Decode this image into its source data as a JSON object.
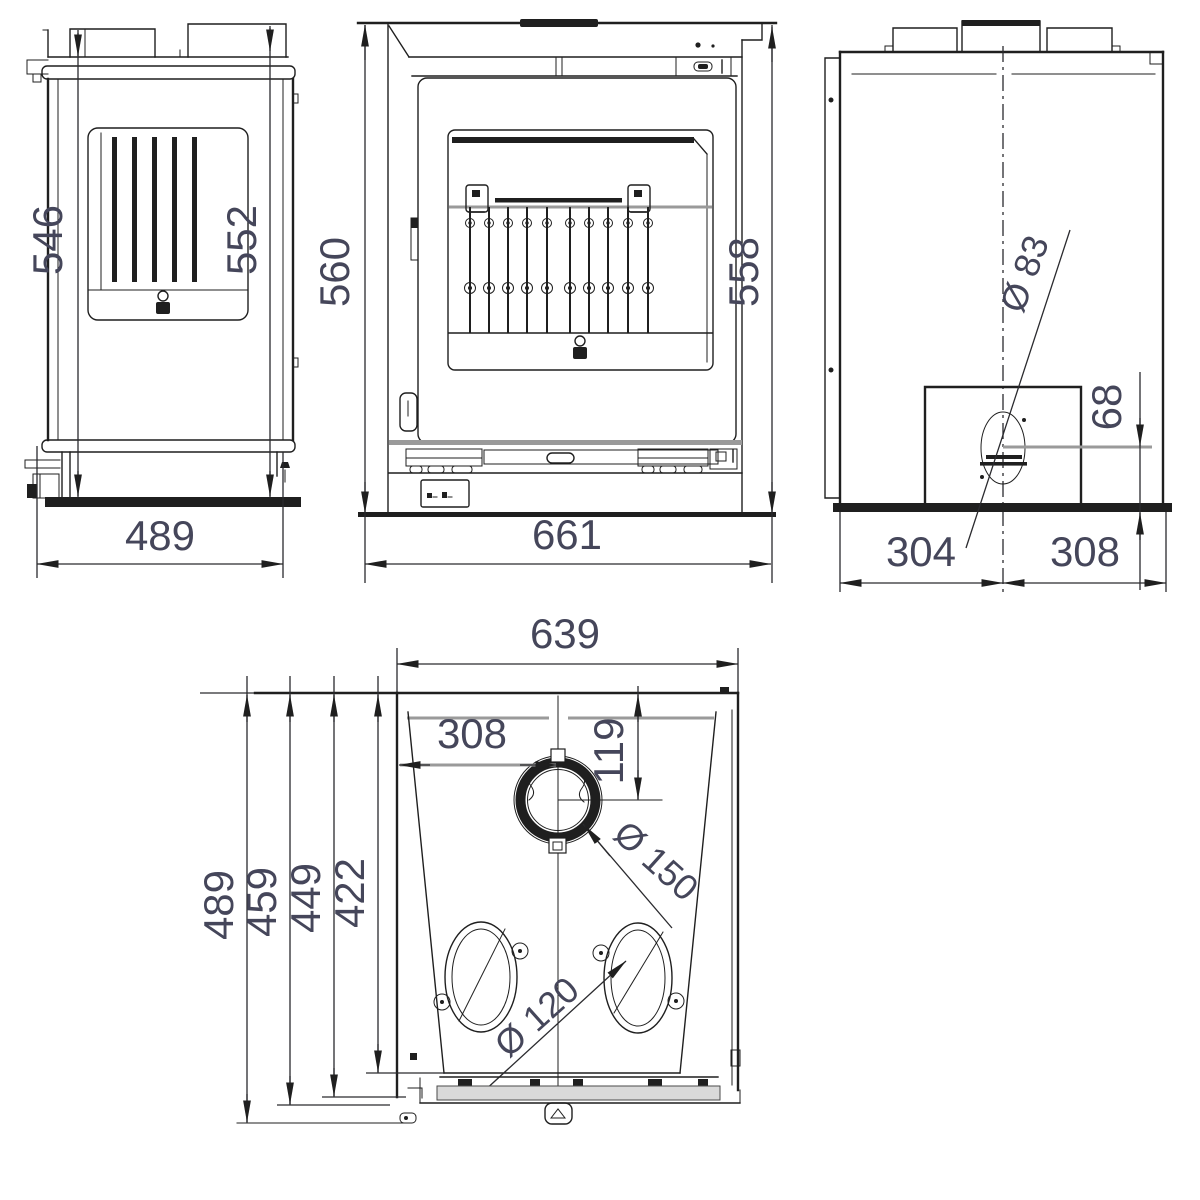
{
  "drawing": {
    "line_color": "#1f1f1f",
    "gray_line_color": "#9a9a9a",
    "dim_text_color": "#45465a",
    "views": {
      "side_view": {
        "dimensions": {
          "height_left": "546",
          "height_right": "552",
          "width_bottom": "489"
        }
      },
      "front_view": {
        "dimensions": {
          "height_left": "560",
          "height_right": "558",
          "width_bottom": "661"
        }
      },
      "rear_view": {
        "dimensions": {
          "flue_diameter_label": "Ø 83",
          "offset_bottom": "68",
          "width_left_of_center": "304",
          "width_right_of_center": "308"
        }
      },
      "top_view": {
        "dimensions": {
          "width_top": "639",
          "flue_center_from_left": "308",
          "flue_center_from_rear": "119",
          "flue_diameter_label": "Ø 150",
          "depth_overall": "489",
          "depth_2": "459",
          "depth_3": "449",
          "depth_4": "422",
          "outlet_diameter_label": "Ø 120"
        }
      }
    }
  }
}
